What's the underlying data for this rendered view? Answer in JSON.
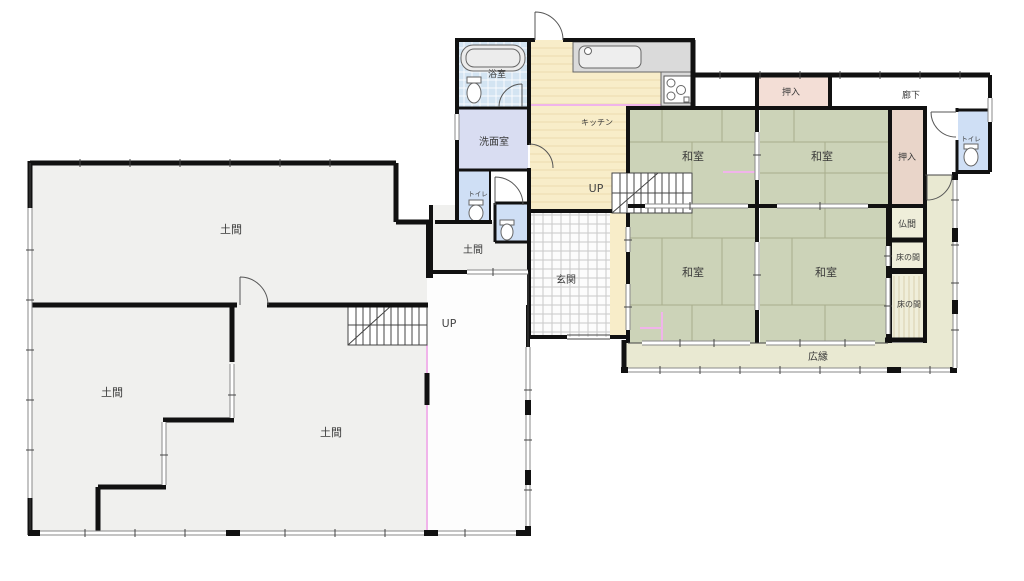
{
  "plan": {
    "labels": {
      "doma_main": "土間",
      "doma_left": "土間",
      "doma_right": "土間",
      "doma_small": "土間",
      "bath": "浴室",
      "washroom": "洗面室",
      "toilet_small": "トイレ",
      "toilet_right": "トイレ",
      "kitchen": "キッチン",
      "entrance": "玄関",
      "up_main": "UP",
      "up_left": "UP",
      "washitsu_nw": "和室",
      "washitsu_ne": "和室",
      "washitsu_sw": "和室",
      "washitsu_se": "和室",
      "oshiire_top": "押入",
      "oshiire_right": "押入",
      "hallway": "廊下",
      "butsuma": "仏間",
      "tokonoma_upper": "床の間",
      "tokonoma_lower": "床の間",
      "veranda": "広縁"
    },
    "colors": {
      "tatami": "#ccd3b8",
      "kitchen_floor": "#f8edc9",
      "bath": "#d3e4f2",
      "washroom": "#d9ddf2",
      "toilet": "#cfdff5",
      "closet_top": "#f3ded6",
      "closet_right": "#e9d5c9",
      "alcove": "#efeeda",
      "veranda": "#e9e9d2",
      "doma": "#f0f0ee",
      "tile_floor": "#fcfcfc",
      "corridor": "#fdfdfd",
      "accent_pink": "#f0b4ea",
      "wall": "#111111"
    }
  }
}
